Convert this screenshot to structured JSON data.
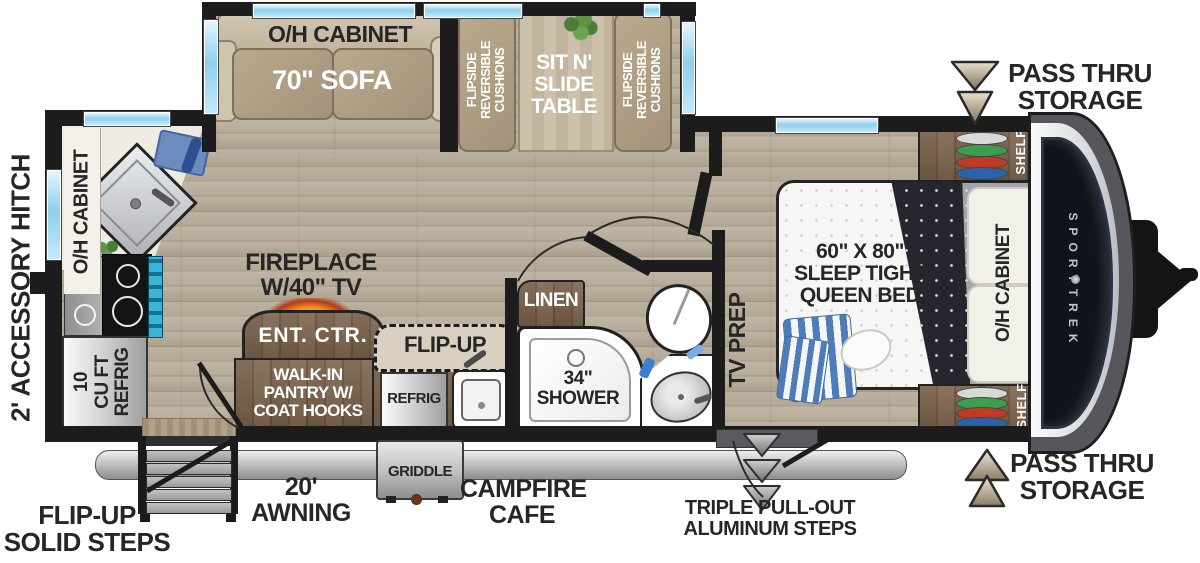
{
  "colors": {
    "wall": "#1c1c1c",
    "window_blue": "#8ecfee",
    "cabinet_brown": "#6f5740",
    "cushion_tan": "#b1a187",
    "floor_wood": "#b6ab9b",
    "fireplace_glow": "#f6891f",
    "hanger_green": "#3c9e4e",
    "hanger_red": "#c13a26",
    "hanger_blue": "#2a64ab",
    "arrow_beige": "#cfc4ae"
  },
  "slideout": {
    "oh_cabinet": "O/H CABINET",
    "sofa": "70\" SOFA",
    "cushion_lines": [
      "FLIPSIDE",
      "REVERSIBLE",
      "CUSHIONS"
    ],
    "table_lines": [
      "SIT N'",
      "SLIDE",
      "TABLE"
    ]
  },
  "kitchen": {
    "oh_cabinet": "O/H CABINET",
    "refrig_lines": [
      "10",
      "CU FT",
      "REFRIG"
    ]
  },
  "living": {
    "fireplace_lines": [
      "FIREPLACE",
      "W/40\" TV"
    ],
    "ent_ctr": "ENT. CTR.",
    "pantry_lines": [
      "WALK-IN",
      "PANTRY W/",
      "COAT HOOKS"
    ]
  },
  "cafe": {
    "flip_up": "FLIP-UP",
    "refrig": "REFRIG",
    "griddle": "GRIDDLE",
    "campfire_lines": [
      "CAMPFIRE",
      "CAFE"
    ]
  },
  "bathroom": {
    "linen": "LINEN",
    "shower_lines": [
      "34\"",
      "SHOWER"
    ],
    "tv_prep": "TV PREP"
  },
  "bedroom": {
    "bed_lines": [
      "60\" X 80\"",
      "SLEEP TIGHT",
      "QUEEN BED"
    ],
    "oh_cabinet": "O/H CABINET",
    "shelf": "SHELF"
  },
  "exterior": {
    "brand": "SPORTTREK",
    "accessory_hitch": "2' ACCESSORY HITCH",
    "pass_thru_lines": [
      "PASS THRU",
      "STORAGE"
    ],
    "flip_up_steps_lines": [
      "FLIP-UP",
      "SOLID STEPS"
    ],
    "awning_lines": [
      "20'",
      "AWNING"
    ],
    "triple_steps_lines": [
      "TRIPLE PULL-OUT",
      "ALUMINUM STEPS"
    ]
  }
}
